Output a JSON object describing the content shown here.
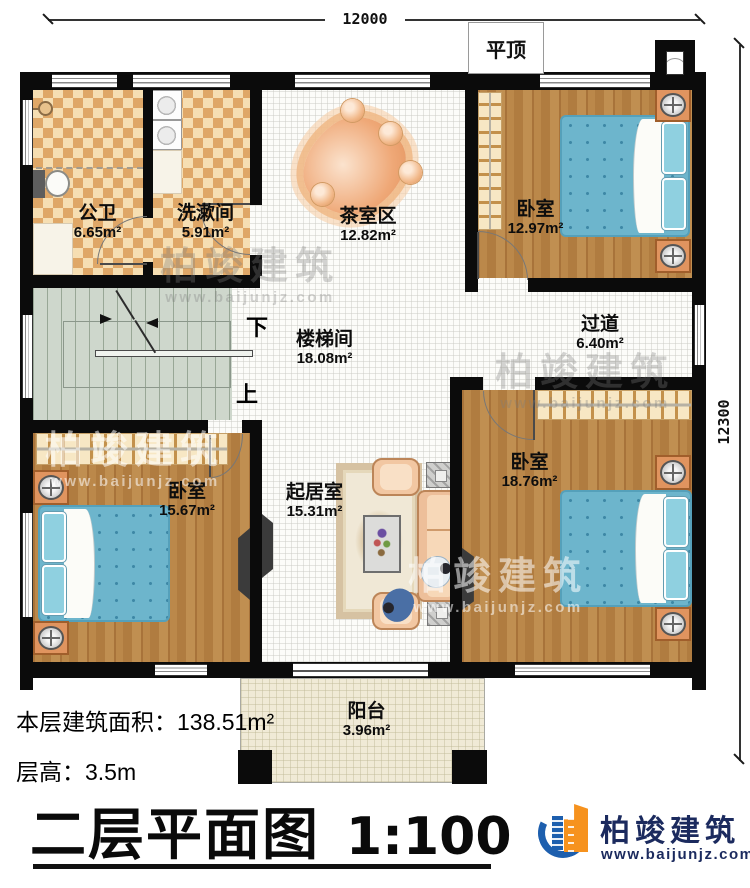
{
  "dimensions": {
    "width": "12000",
    "height": "12300"
  },
  "annotations": {
    "flat_roof": "平顶",
    "stairs_down": "下",
    "stairs_up": "上"
  },
  "rooms": [
    {
      "id": "public-bathroom",
      "name": "公卫",
      "area": "6.65m²"
    },
    {
      "id": "washroom",
      "name": "洗漱间",
      "area": "5.91m²"
    },
    {
      "id": "tea-area",
      "name": "茶室区",
      "area": "12.82m²"
    },
    {
      "id": "bedroom-top-right",
      "name": "卧室",
      "area": "12.97m²"
    },
    {
      "id": "corridor",
      "name": "过道",
      "area": "6.40m²"
    },
    {
      "id": "stairwell",
      "name": "楼梯间",
      "area": "18.08m²"
    },
    {
      "id": "bedroom-bottom-left",
      "name": "卧室",
      "area": "15.67m²"
    },
    {
      "id": "living-room",
      "name": "起居室",
      "area": "15.31m²"
    },
    {
      "id": "bedroom-bottom-right",
      "name": "卧室",
      "area": "18.76m²"
    },
    {
      "id": "balcony",
      "name": "阳台",
      "area": "3.96m²"
    }
  ],
  "info": {
    "floor_area_label": "本层建筑面积：",
    "floor_area_value": "138.51m²",
    "floor_height_label": "层高：",
    "floor_height_value": "3.5m"
  },
  "title": {
    "text": "二层平面图",
    "scale": "1:100"
  },
  "logo": {
    "company": "柏竣建筑",
    "website": "www.baijunjz.com"
  },
  "watermark": {
    "text": "柏竣建筑",
    "url": "www.baijunjz.com"
  },
  "colors": {
    "wall": "#0b0b0b",
    "wood_floor": "#b5823f",
    "checker_dark": "#dfa767",
    "checker_light": "#f6deb2",
    "tile_floor": "#fcfcf9",
    "stairs": "#ced7cc",
    "bed_blue": "#6db5cc",
    "sofa_salmon": "#eec39f",
    "balcony_floor": "#f0ead6",
    "logo_blue": "#1d5fae",
    "logo_orange": "#f6921e",
    "logo_navy": "#1b2a5e"
  }
}
